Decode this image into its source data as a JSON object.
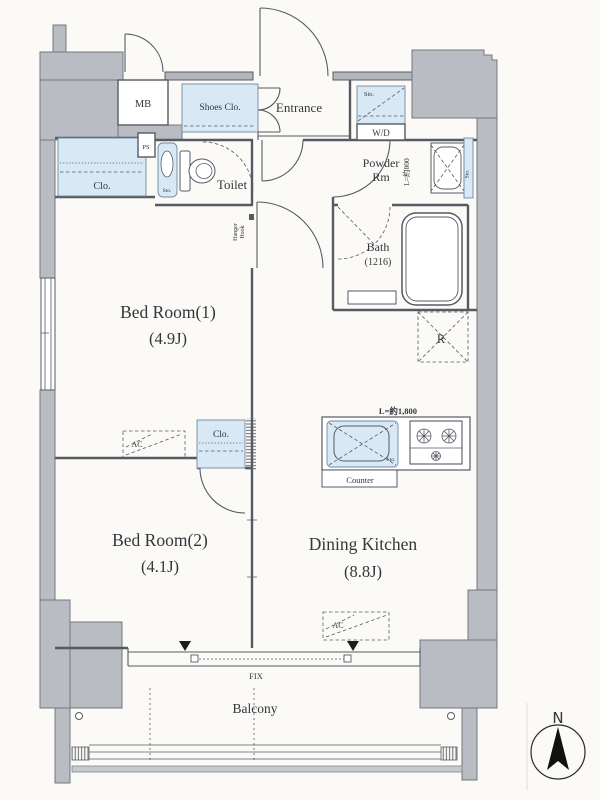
{
  "title": "Apartment floor plan (1LDK+S layout)",
  "colors": {
    "wall_gray": "#b9bdc3",
    "fixture_blue": "#d8e8f4",
    "line": "#565b63",
    "text": "#33363c",
    "marker_black": "#1c1c1c",
    "background": "#fbfaf7"
  },
  "labels": {
    "mb": "MB",
    "shoes_closet": "Shoes Clo.",
    "entrance": "Entrance",
    "wd_sto": "Sto.",
    "wd": "W/D",
    "ps": "PS",
    "closet_top": "Clo.",
    "toilet_sto": "Sto.",
    "toilet": "Toilet",
    "powder_room_1": "Powder",
    "powder_room_2": "Rm",
    "powder_rail_length": "L=約800",
    "powder_sto": "Sto.",
    "hanger_1": "Hanger",
    "hanger_2": "Hook",
    "bath_1": "Bath",
    "bath_2": "(1216)",
    "bedroom1_1": "Bed Room(1)",
    "bedroom1_2": "(4.9J)",
    "fridge": "R",
    "ac_bedroom1": "AC",
    "closet_mid": "Clo.",
    "kitchen_rail_length": "L=約1,800",
    "sink_sto": "Sto.",
    "counter": "Counter",
    "bedroom2_1": "Bed Room(2)",
    "bedroom2_2": "(4.1J)",
    "dk_1": "Dining Kitchen",
    "dk_2": "(8.8J)",
    "ac_dk": "AC",
    "fix": "FIX",
    "balcony": "Balcony",
    "compass_n": "N"
  }
}
